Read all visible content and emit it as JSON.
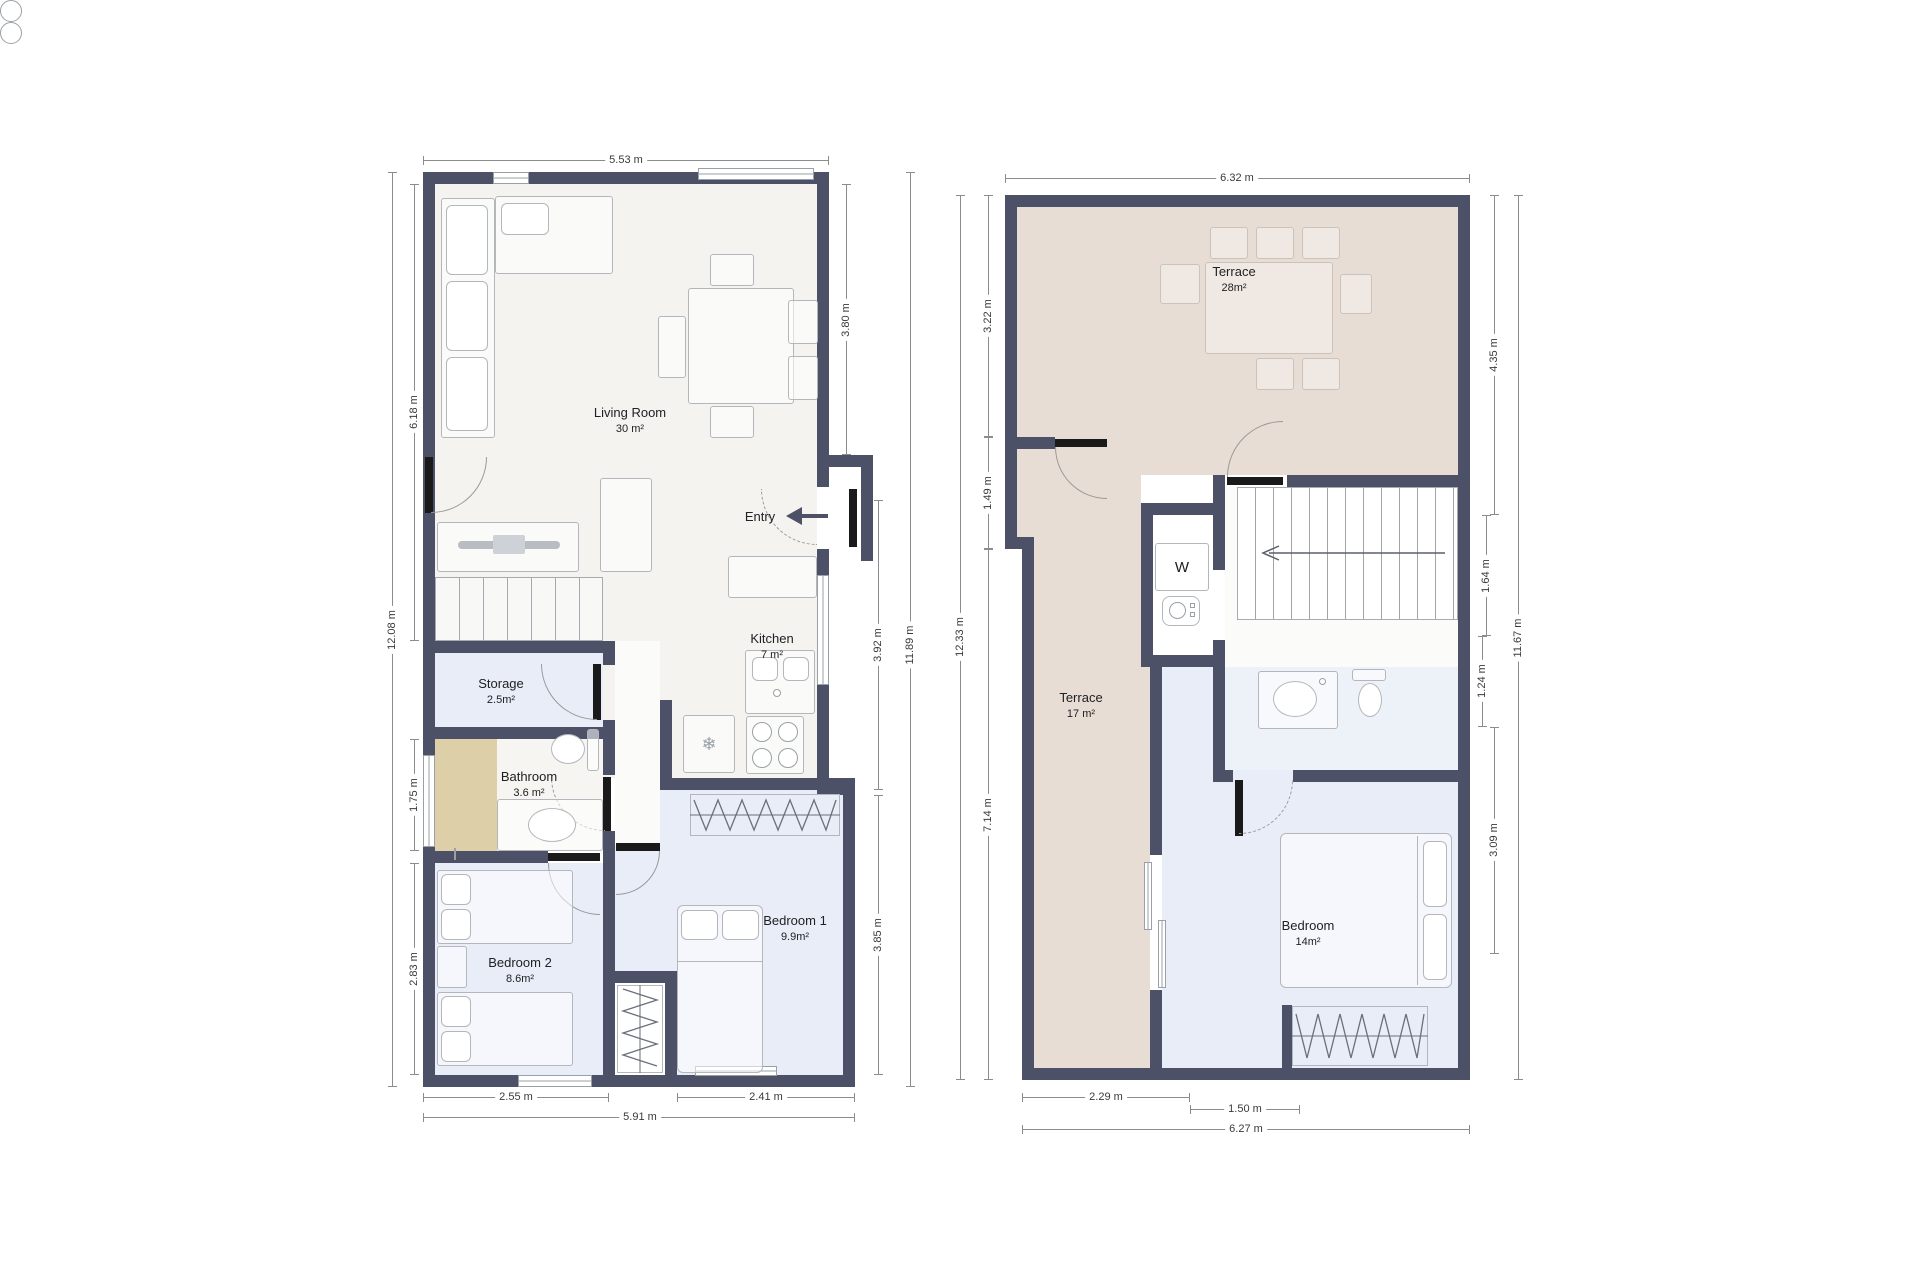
{
  "colors": {
    "wall": "#4d5168",
    "floor_main": "#f4f3f0",
    "floor_room": "#e9edf8",
    "terrace": "#e8ddd5",
    "shower": "#ddd0a8",
    "label_text": "#202124",
    "dim_text": "#3a3a3a"
  },
  "plan1": {
    "entry_label": "Entry",
    "rooms": {
      "living": {
        "name": "Living Room",
        "area": "30 m²"
      },
      "kitchen": {
        "name": "Kitchen",
        "area": "7 m²"
      },
      "storage": {
        "name": "Storage",
        "area": "2.5m²"
      },
      "bathroom": {
        "name": "Bathroom",
        "area": "3.6 m²"
      },
      "bedroom1": {
        "name": "Bedroom 1",
        "area": "9.9m²"
      },
      "bedroom2": {
        "name": "Bedroom 2",
        "area": "8.6m²"
      }
    },
    "dims": {
      "top": "5.53 m",
      "left_outer": "12.08 m",
      "left_living": "6.18 m",
      "left_bathroom": "1.75 m",
      "left_bedroom2": "2.83 m",
      "right_living": "3.80 m",
      "right_kitchen": "3.92 m",
      "right_outer": "11.89 m",
      "right_bedroom1": "3.85 m",
      "bottom_bedroom2": "2.55 m",
      "bottom_bedroom1": "2.41 m",
      "bottom_outer": "5.91 m"
    }
  },
  "plan2": {
    "washer_label": "W",
    "rooms": {
      "terrace_upper": {
        "name": "Terrace",
        "area": "28m²"
      },
      "terrace_lower": {
        "name": "Terrace",
        "area": "17 m²"
      },
      "bedroom": {
        "name": "Bedroom",
        "area": "14m²"
      }
    },
    "dims": {
      "top": "6.32 m",
      "left_upper": "3.22 m",
      "left_mid": "1.49 m",
      "left_outer": "12.33 m",
      "left_lower": "7.14 m",
      "right_terrace": "4.35 m",
      "right_stairs": "1.64 m",
      "right_outer": "11.67 m",
      "right_bathroom": "1.24 m",
      "right_bedroom": "3.09 m",
      "bottom_terrace": "2.29 m",
      "bottom_wardrobe": "1.50 m",
      "bottom_outer": "6.27 m"
    }
  }
}
